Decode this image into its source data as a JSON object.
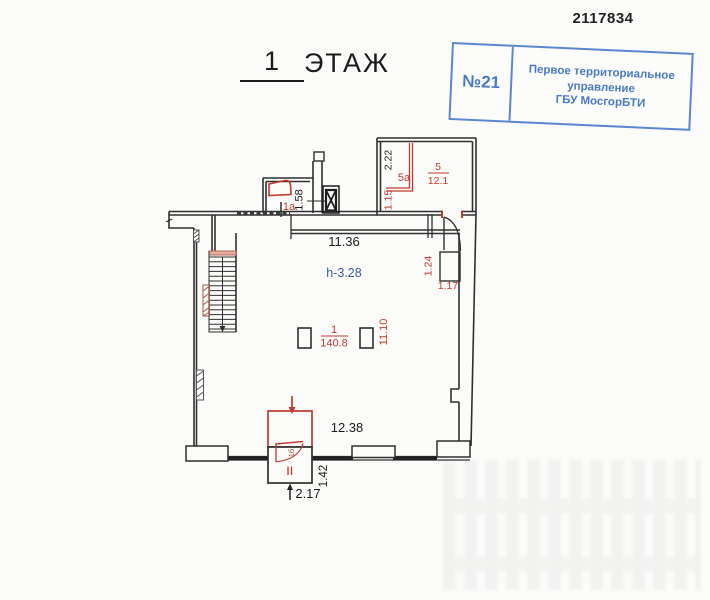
{
  "document": {
    "number": "2117834",
    "title": {
      "floor": "1",
      "word": "ЭТАЖ"
    }
  },
  "stamp": {
    "number": "№21",
    "line1": "Первое территориальное",
    "line2": "управление",
    "line3": "ГБУ МосгорБТИ"
  },
  "plan": {
    "height_mark": "h-3.28",
    "rooms": {
      "r1": {
        "number": "1",
        "area": "140.8"
      },
      "r1a": {
        "label": "1а"
      },
      "r1b": {
        "label": "1б"
      },
      "r5": {
        "number": "5",
        "area": "12.1"
      },
      "r5a": {
        "label": "5а"
      }
    },
    "dims": {
      "d1136": "11.36",
      "d1238": "12.38",
      "d1110": "11.10",
      "d158": "1.58",
      "d222": "2.22",
      "d115": "1.15",
      "d124": "1.24",
      "d117": "1.17",
      "d142": "1.42",
      "d217": "2.17"
    },
    "colors": {
      "wall": "#2f2f2f",
      "red": "#c03a2e",
      "blue": "#3a5aa8",
      "stamp_blue": "#4a7ac6"
    }
  }
}
